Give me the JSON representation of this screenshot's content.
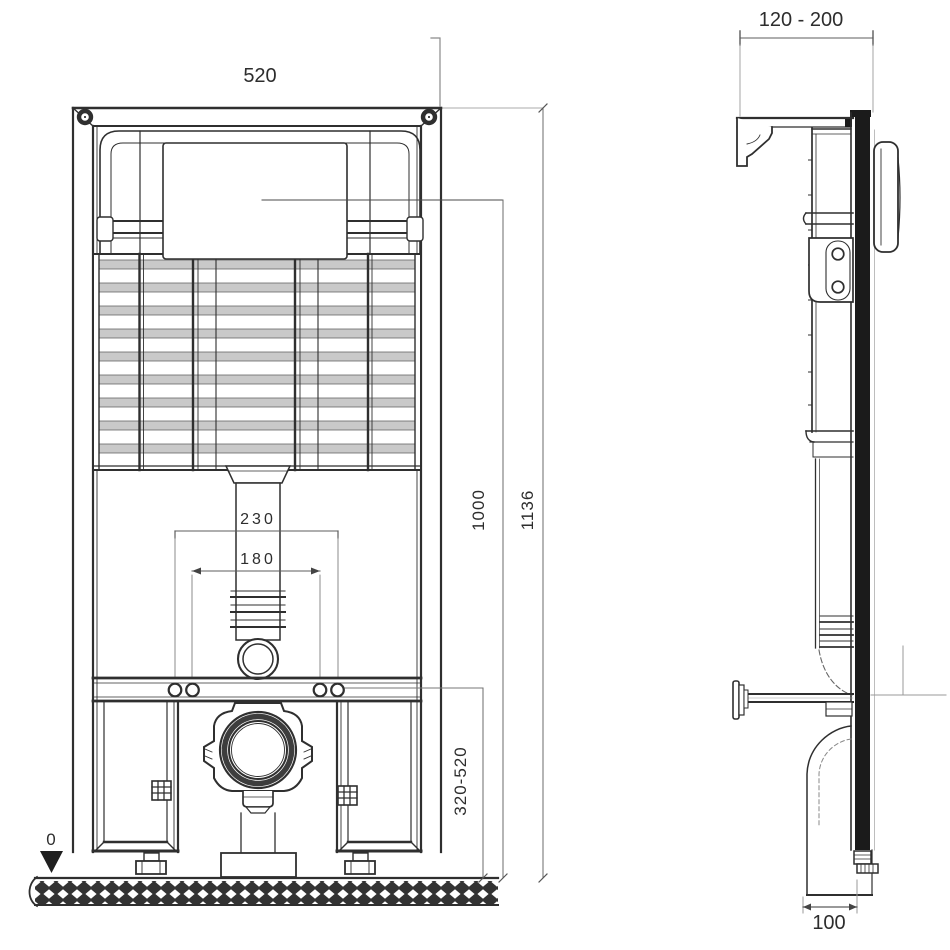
{
  "views": {
    "front": {
      "width_mm": "520",
      "flush_panel_height_mm": "1000",
      "total_height_mm": "1136",
      "fixing_spacing_outer_mm": "230",
      "fixing_spacing_inner_mm": "180",
      "outlet_height_range_mm": "320-520",
      "floor_level": "0"
    },
    "side": {
      "depth_range_mm": "120 - 200",
      "base_depth_mm": "100"
    }
  },
  "colors": {
    "line": "#2f2f2f",
    "dim": "#6b6b6b",
    "dim_light": "#9a9a9a",
    "grid_fill": "#c9c9c9",
    "rail_fill": "#1b1b1b",
    "bg": "#ffffff",
    "text": "#2d2d2d"
  }
}
